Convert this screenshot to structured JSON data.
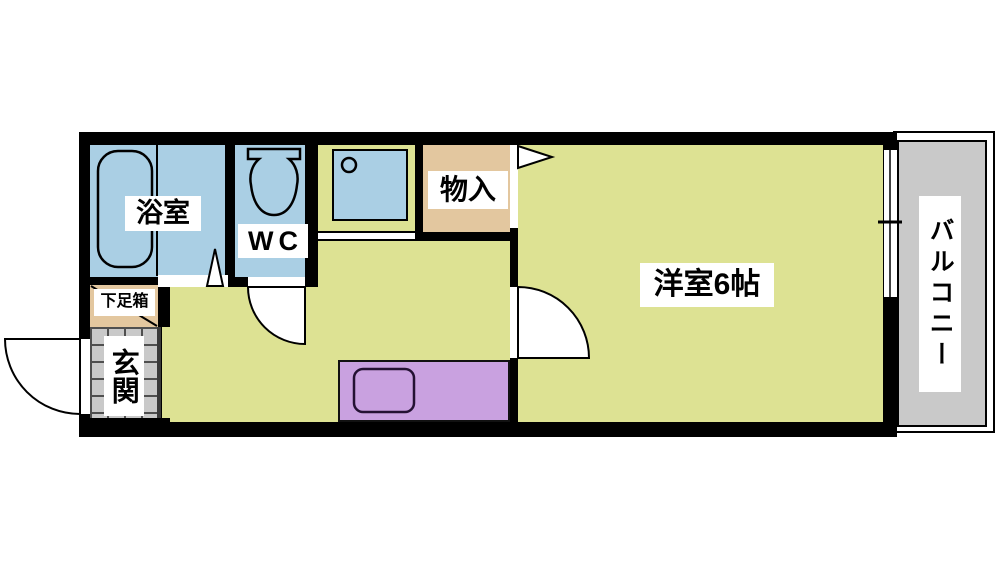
{
  "floorplan": {
    "type": "apartment-floor-plan-1K",
    "labels": {
      "bath": "浴室",
      "wc": "WC",
      "storage": "物入",
      "main_room": "洋室6帖",
      "balcony": "バルコニー",
      "shoe_box": "下足箱",
      "entrance": "玄関"
    },
    "colors": {
      "wet_area_blue": "#aacfe4",
      "floor_yellow_green": "#dde293",
      "storage_tan": "#e3c79f",
      "kitchen_counter_purple": "#c9a1e0",
      "balcony_gray": "#c9c9c9",
      "entrance_tile_gray": "#c9c9c9",
      "wall_black": "#000000",
      "label_background": "#ffffff"
    },
    "fixtures": {
      "bathtub": "bathtub-icon",
      "toilet": "toilet-icon",
      "washer_pan": "washer-pan-icon",
      "kitchen_sink": "kitchen-sink-icon"
    },
    "symbols": {
      "entrance_door": "entrance-door-swing-arc",
      "wc_door": "wc-door-swing-arc",
      "main_room_door": "main-room-door-swing-arc",
      "bath_door": "bath-door-triangle",
      "storage_door": "storage-door-flag",
      "balcony_window": "sliding-window"
    }
  }
}
